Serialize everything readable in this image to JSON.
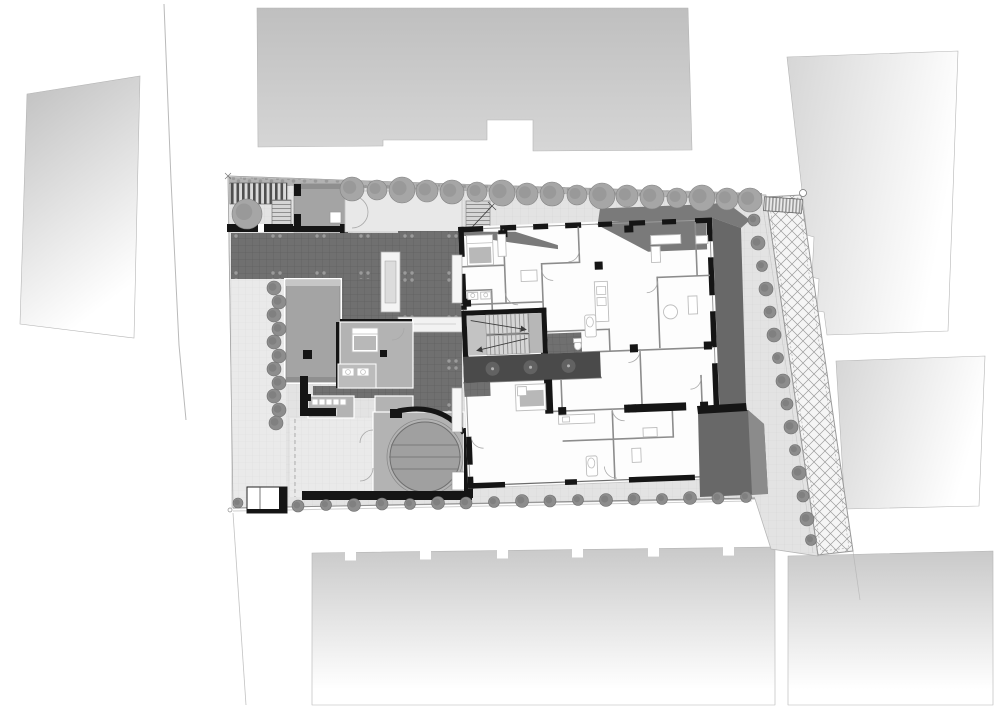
{
  "scene": {
    "kind": "architectural-site-plan",
    "view": "top-down plan",
    "visible_text": []
  },
  "palette": {
    "paper": "#ffffff",
    "line": "#a8a8a8",
    "site_base": "#e3e3e3",
    "grid_line": "#d6d6d6",
    "site_light": "#eaeaea",
    "grid_light": "#dedede",
    "hedge": "#b2b2b2",
    "hedge_dot": "#939393",
    "tile": "#707070",
    "tile_line": "#606060",
    "tile_dot": "#a6a6a6",
    "corridor": "#4a4a4a",
    "corridor_glow": "#9a9a9a",
    "roof": "#a4a4a4",
    "roof_edge": "#8d8d8d",
    "room": "#b3b3b3",
    "room_dark": "#9e9e9e",
    "wall": "#151515",
    "wall_thin": "#8c8c8c",
    "furniture": "#bdbdbd",
    "blanket": "#b8b8b8",
    "shadow": "#7a7a7a",
    "shadow_dark": "#686868",
    "tree": "#a6a6a6",
    "tree_edge": "#828282",
    "bush": "#8d8d8d",
    "bush_edge": "#6e6e6e",
    "hatch_bg": "#f5f5f5",
    "hatch_line": "#9c9c9c",
    "stripe": "#4f4f4f",
    "stripe_bg": "#d9d9d9",
    "grate": "#9a9a9a",
    "grate_bg": "#ececec",
    "tread": "#8f8f8f",
    "flight_bg": "#d6d6d6",
    "landing": "#c3c3c3",
    "neighbor_dark": "#bfbfbf",
    "neighbor": "#c9c9c9",
    "neighbor_mid": "#d6d6d6",
    "neighbor_fade": "#ffffff",
    "white": "#ffffff"
  },
  "vegetation": {
    "trees_top": [
      [
        352,
        189,
        12
      ],
      [
        377,
        190,
        10
      ],
      [
        402,
        190,
        13
      ],
      [
        427,
        191,
        11
      ],
      [
        452,
        192,
        12
      ],
      [
        477,
        192,
        10
      ],
      [
        502,
        193,
        13
      ],
      [
        527,
        194,
        11
      ],
      [
        552,
        194,
        12
      ],
      [
        577,
        195,
        10
      ],
      [
        602,
        196,
        13
      ],
      [
        627,
        196,
        11
      ],
      [
        652,
        197,
        12
      ],
      [
        677,
        198,
        10
      ],
      [
        702,
        198,
        13
      ],
      [
        727,
        199,
        11
      ],
      [
        750,
        200,
        12
      ]
    ],
    "bushes_bottom": [
      [
        298,
        506,
        6
      ],
      [
        326,
        505,
        5.5
      ],
      [
        354,
        505,
        6.5
      ],
      [
        382,
        504,
        6
      ],
      [
        410,
        504,
        5.5
      ],
      [
        438,
        503,
        6.5
      ],
      [
        466,
        503,
        6
      ],
      [
        494,
        502,
        5.5
      ],
      [
        522,
        501,
        6.5
      ],
      [
        550,
        501,
        6
      ],
      [
        578,
        500,
        5.5
      ],
      [
        606,
        500,
        6.5
      ],
      [
        634,
        499,
        6
      ],
      [
        662,
        499,
        5.5
      ],
      [
        690,
        498,
        6.5
      ],
      [
        718,
        498,
        6
      ],
      [
        746,
        497,
        5.5
      ]
    ],
    "bushes_left": [
      [
        274,
        288,
        7
      ],
      [
        279,
        302,
        7
      ],
      [
        274,
        315,
        7
      ],
      [
        279,
        329,
        7
      ],
      [
        274,
        342,
        7
      ],
      [
        279,
        356,
        7
      ],
      [
        274,
        369,
        7
      ],
      [
        279,
        383,
        7
      ],
      [
        274,
        396,
        7
      ],
      [
        279,
        410,
        7
      ],
      [
        276,
        423,
        7
      ]
    ],
    "bushes_right": [
      [
        754,
        220,
        6
      ],
      [
        758,
        243,
        7
      ],
      [
        762,
        266,
        5.5
      ],
      [
        766,
        289,
        7
      ],
      [
        770,
        312,
        6
      ],
      [
        774,
        335,
        7
      ],
      [
        778,
        358,
        5.5
      ],
      [
        783,
        381,
        7
      ],
      [
        787,
        404,
        6
      ],
      [
        791,
        427,
        7
      ],
      [
        795,
        450,
        5.5
      ],
      [
        799,
        473,
        7
      ],
      [
        803,
        496,
        6
      ],
      [
        807,
        519,
        7
      ],
      [
        811,
        540,
        5.5
      ]
    ],
    "specimen_tree": [
      [
        247,
        214,
        15
      ]
    ],
    "kiosk_bush": [
      [
        238,
        503,
        5
      ]
    ]
  }
}
